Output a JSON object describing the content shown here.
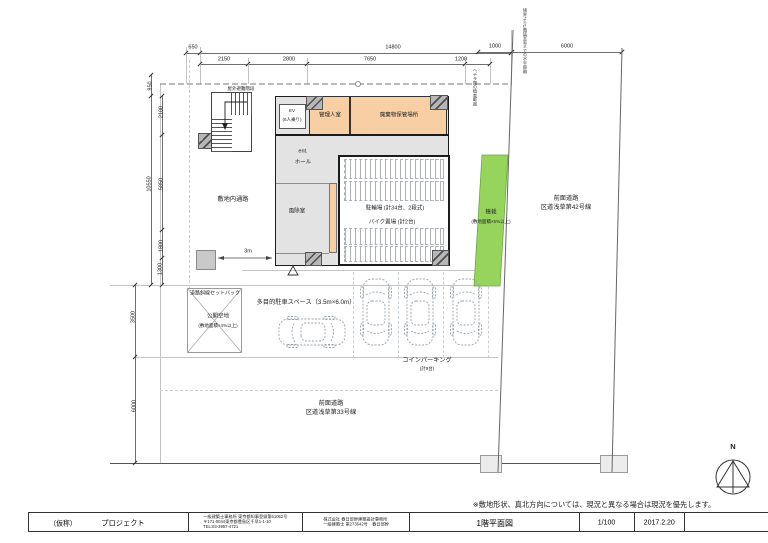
{
  "colors": {
    "room_orange": "#f8cfa4",
    "building_gray": "#e3e3e3",
    "planting_green": "#97d45e",
    "hatch_gray": "#b7b7b7",
    "guide_blue": "#c9d1d7"
  },
  "compass": {
    "label": "N"
  },
  "note": "※敷地形状、真北方向については、現況と異なる場合は現況を優先します。",
  "title_block": {
    "project_prefix": "（仮称）",
    "project_name": "プロジェクト",
    "office_line1": "一級建築士事務所 東京都知事登録第61062号",
    "office_line2": "〒171-0044東京都豊島区千早1-1-10",
    "office_line3": "TEL:03-3957-4721",
    "company_line1": "株式会社 春日部幹建築設計事務所",
    "company_line2": "一級建築士 第273642号　春日部幹",
    "drawing_title": "1階平面図",
    "scale": "1/100",
    "date": "2017.2.20"
  },
  "plan": {
    "labels": {
      "outdoor_stair": "屋外避難階段",
      "ev": "EV",
      "ev_sub": "(6人乗り)",
      "manager_room": "管理人室",
      "waste_storage": "廃棄物保管場所",
      "ent": "ent.",
      "hall": "ホール",
      "site_passage": "敷地内通路",
      "windbreak_room": "風除室",
      "bicycle_parking": "駐輪場 (計34台、2段式)",
      "bike_parking": "バイク置場 (計2台)",
      "planting": "植栽",
      "planting_sub": "(敷地面積×5%以上)",
      "front_road_east_1": "前面道路",
      "front_road_east_2": "区道浅草第42号線",
      "public_open_space": "公開空地",
      "public_open_space_sub": "(敷地面積×4%以上)",
      "road_setback": "道路斜線セットバック",
      "multipurpose_parking": "多目的駐車スペース（3.5m×6.0m）",
      "coin_parking": "コインパーキング",
      "coin_parking_sub": "(計9台)",
      "front_road_south_1": "前面道路",
      "front_road_south_2": "区道浅草第33号線",
      "entrance_mark": "△",
      "vertical_note_boundary": "境界より1階居室窓までの水平距離",
      "vertical_note_planting": "ヘデラ類の植栽範囲"
    },
    "dims": {
      "top": [
        "650",
        "14800",
        "2150",
        "2800",
        "7650",
        "1200"
      ],
      "right": [
        "1000",
        "6000"
      ],
      "left": [
        "950",
        "2100",
        "10550",
        "5850",
        "1800",
        "1300",
        "3500",
        "6000"
      ],
      "misc_3m": "3m"
    }
  }
}
